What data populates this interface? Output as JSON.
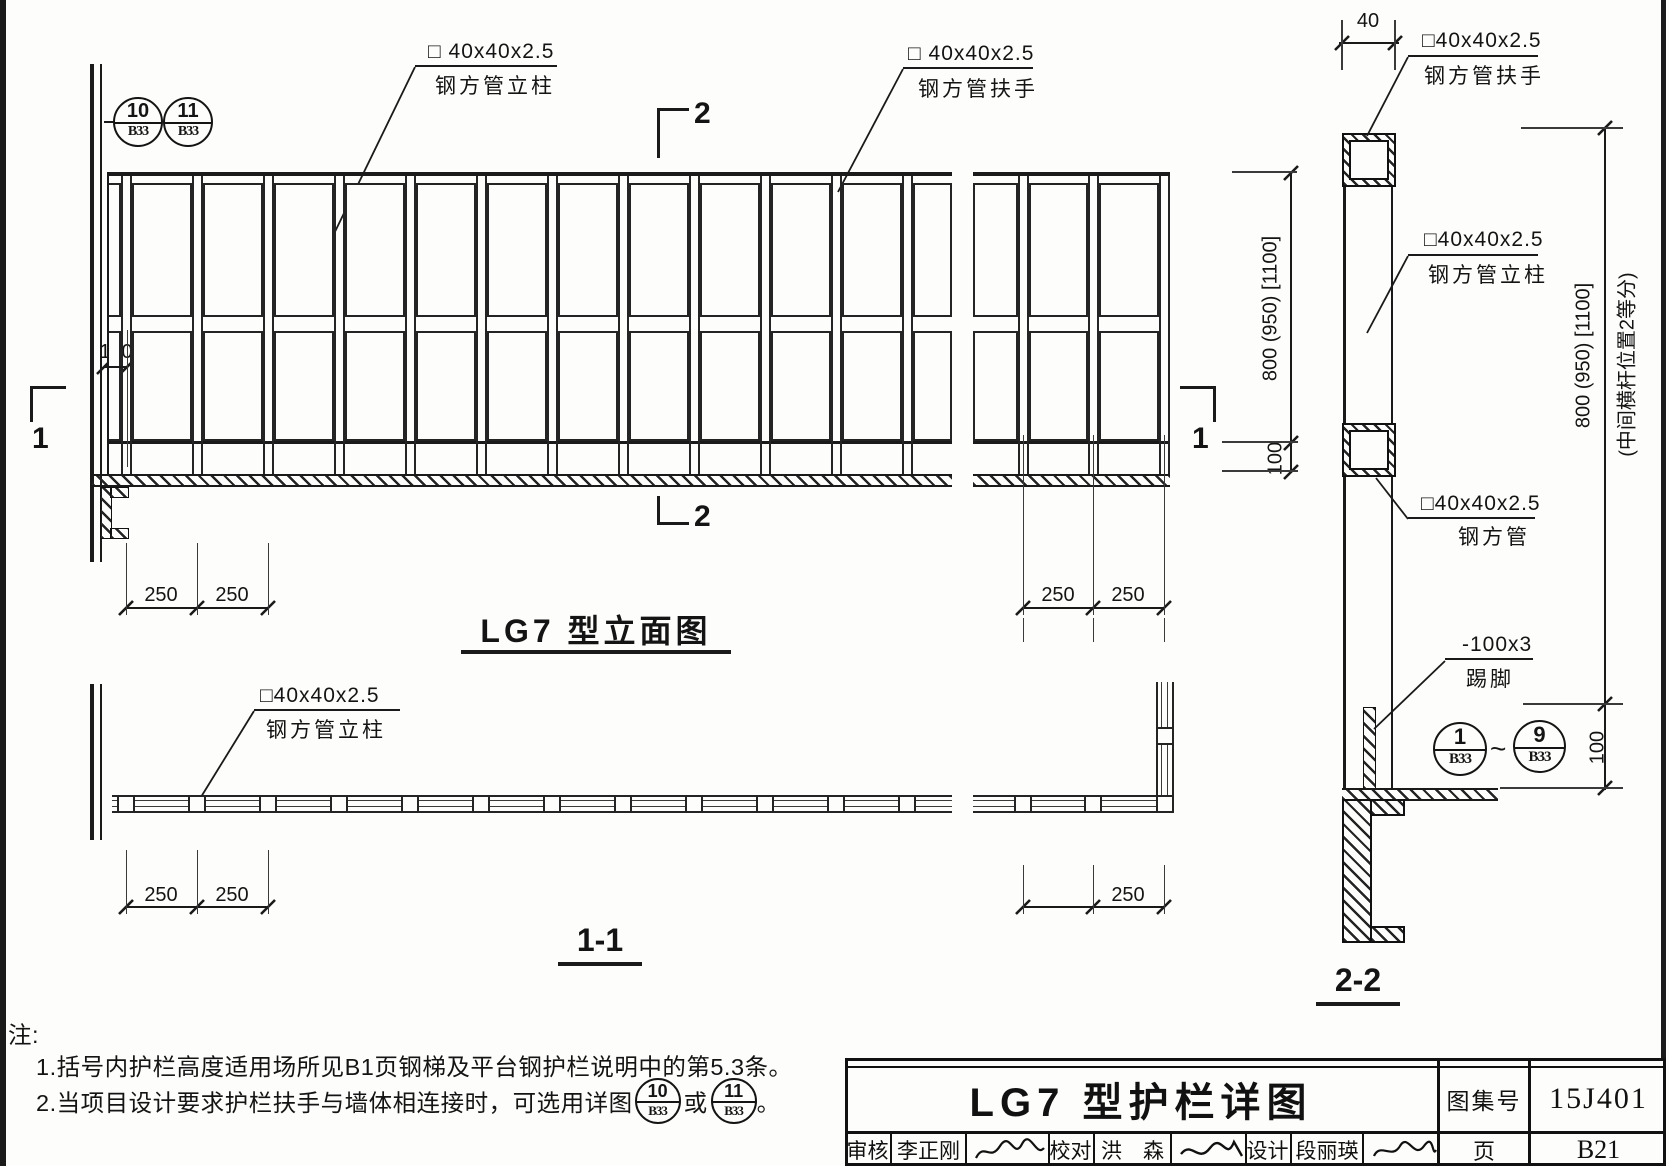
{
  "drawing": {
    "elevation_title": "LG7 型立面图",
    "plan_title": "1-1",
    "section_title": "2-2",
    "labels": {
      "elev_post": [
        "□ 40x40x2.5",
        "钢方管立柱"
      ],
      "elev_handrail": [
        "□ 40x40x2.5",
        "钢方管扶手"
      ],
      "sec_handrail": [
        "□40x40x2.5",
        "钢方管扶手"
      ],
      "sec_post": [
        "□40x40x2.5",
        "钢方管立柱"
      ],
      "sec_midrail": [
        "□40x40x2.5",
        "钢方管"
      ],
      "sec_kick": [
        "-100x3",
        "踢脚"
      ],
      "plan_post": [
        "□40x40x2.5",
        "钢方管立柱"
      ]
    },
    "dims": {
      "wall_offset": "100",
      "bay": "250",
      "tube_width": "40",
      "rail_height": "800 (950) [1100]",
      "rail_height_note": "(中间横杆位置2等分)",
      "kick_height": "100"
    },
    "bubbles": {
      "d10": [
        "10",
        "B33"
      ],
      "d11": [
        "11",
        "B33"
      ],
      "d1": [
        "1",
        "B33"
      ],
      "d9": [
        "9",
        "B33"
      ],
      "range_tilde": "~"
    },
    "section_marks": {
      "s1": "1",
      "s2": "2"
    }
  },
  "notes": {
    "heading": "注:",
    "item1": "1.括号内护栏高度适用场所见B1页钢梯及平台钢护栏说明中的第5.3条。",
    "item2_pre": "2.当项目设计要求护栏扶手与墙体相连接时，可选用详图",
    "item2_or": "或",
    "item2_end": "。"
  },
  "titleblock": {
    "title": "LG7 型护栏详图",
    "atlas_label": "图集号",
    "atlas_no": "15J401",
    "page_label": "页",
    "page_no": "B21",
    "staff": [
      {
        "role": "审核",
        "name": "李正刚"
      },
      {
        "role": "校对",
        "name": "洪　森"
      },
      {
        "role": "设计",
        "name": "段丽瑛"
      }
    ]
  }
}
